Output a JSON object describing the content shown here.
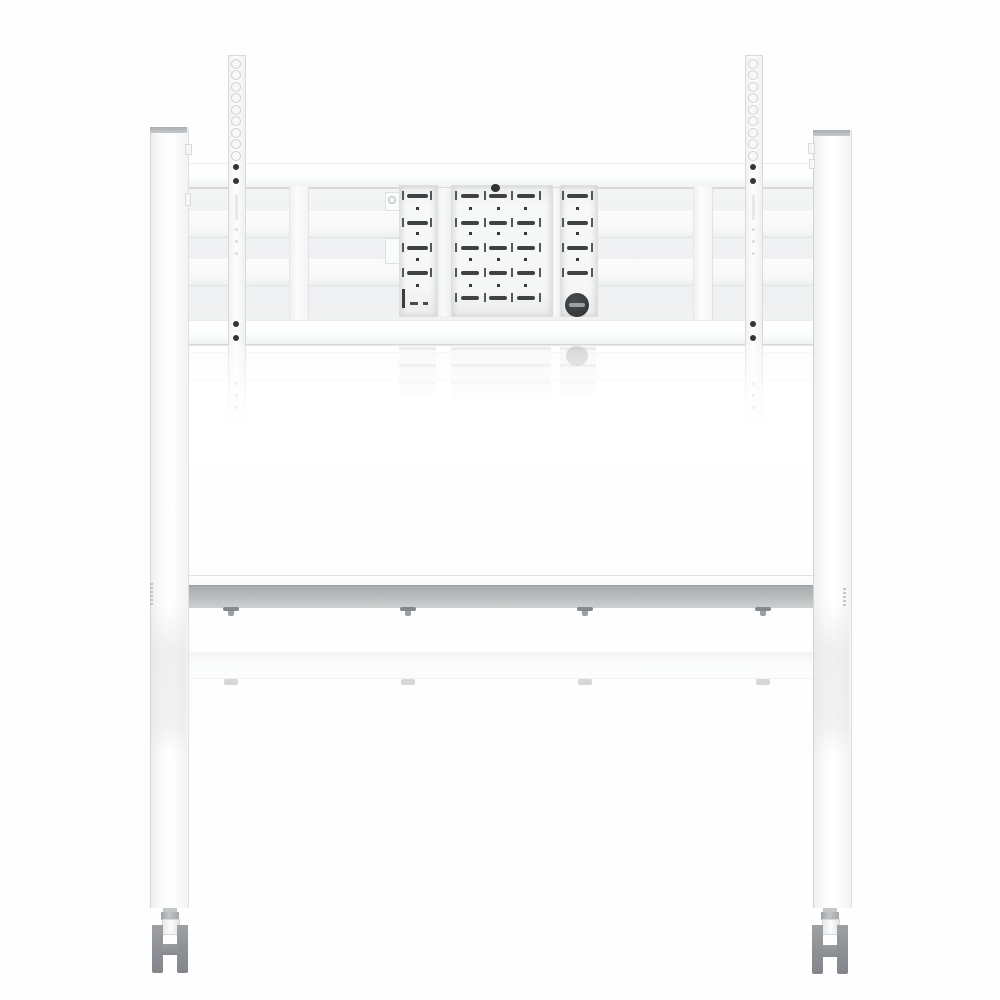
{
  "meta": {
    "image_type": "product-photo",
    "subject": "White mobile TV / display floor stand, front view",
    "visible_text": "none (only tiny illegible label marks on leg edges)"
  },
  "colors": {
    "background": "#fefefe",
    "metal_white": "#fbfcfc",
    "backdrop_grey": "#f0f1f2",
    "edge_grey": "#d8d9db",
    "slot_dark": "#3f4144",
    "screw_dark": "#323437",
    "knob_dark": "#3a3c3f",
    "knob_slot": "#9ba1a5",
    "shelf_face_dark": "#a9acae",
    "shelf_face_light": "#ced0d1",
    "caster_grey": "#909396",
    "cap_grey": "#abaeb1",
    "label_grey": "#b7b9ba"
  },
  "parts": {
    "legs": [
      "left-leg-column",
      "right-leg-column"
    ],
    "crossbars": [
      "upper-crossbar",
      "lower-crossbar",
      "recessed-back-rail-1",
      "recessed-back-rail-2"
    ],
    "mount": [
      "left-tv-rail",
      "right-tv-rail",
      "left-vesa-plate",
      "center-vesa-plate",
      "right-vesa-plate",
      "lock-knob"
    ],
    "shelf": "equipment-shelf-with-4-screws",
    "casters": [
      "left-caster-fork",
      "right-caster-fork"
    ],
    "reflections": [
      "bracket-reflection",
      "shelf-reflection"
    ]
  },
  "bracket": {
    "left_plate": {
      "slot_rows_y": [
        194,
        221,
        246,
        271
      ],
      "dot_rows_y": [
        207,
        232,
        258,
        284
      ],
      "slot_xs": [
        407
      ],
      "slot_w": 21,
      "dot_xs": [
        416
      ],
      "tick_xs": [
        402,
        430
      ]
    },
    "center_plate": {
      "slot_rows_y": [
        194,
        221,
        246,
        271,
        296
      ],
      "dot_rows_y": [
        207,
        232,
        258,
        284
      ],
      "slot_xs": [
        461,
        489,
        517
      ],
      "slot_w": 18,
      "dot_xs": [
        469,
        497,
        524
      ],
      "tick_xs": [
        455,
        484,
        511,
        539
      ]
    },
    "right_plate": {
      "slot_rows_y": [
        194,
        221,
        246,
        271
      ],
      "dot_rows_y": [
        207,
        232,
        258
      ],
      "slot_xs": [
        567
      ],
      "slot_w": 21,
      "dot_xs": [
        576
      ],
      "tick_xs": [
        562,
        591
      ]
    }
  },
  "rails": {
    "centers_x": [
      236,
      753
    ],
    "hole_rings_cy": [
      64,
      75,
      87,
      98,
      110,
      121,
      133,
      144,
      156
    ],
    "screws_cy": [
      167,
      181,
      324,
      338
    ],
    "mid_slots": [
      {
        "y": 194,
        "h": 26
      }
    ],
    "mid_dots_cy": [
      228,
      240,
      252
    ],
    "lower_dots_cy": [
      382,
      394,
      406
    ]
  },
  "shelf": {
    "screws_x": [
      231,
      408,
      585,
      763
    ]
  }
}
